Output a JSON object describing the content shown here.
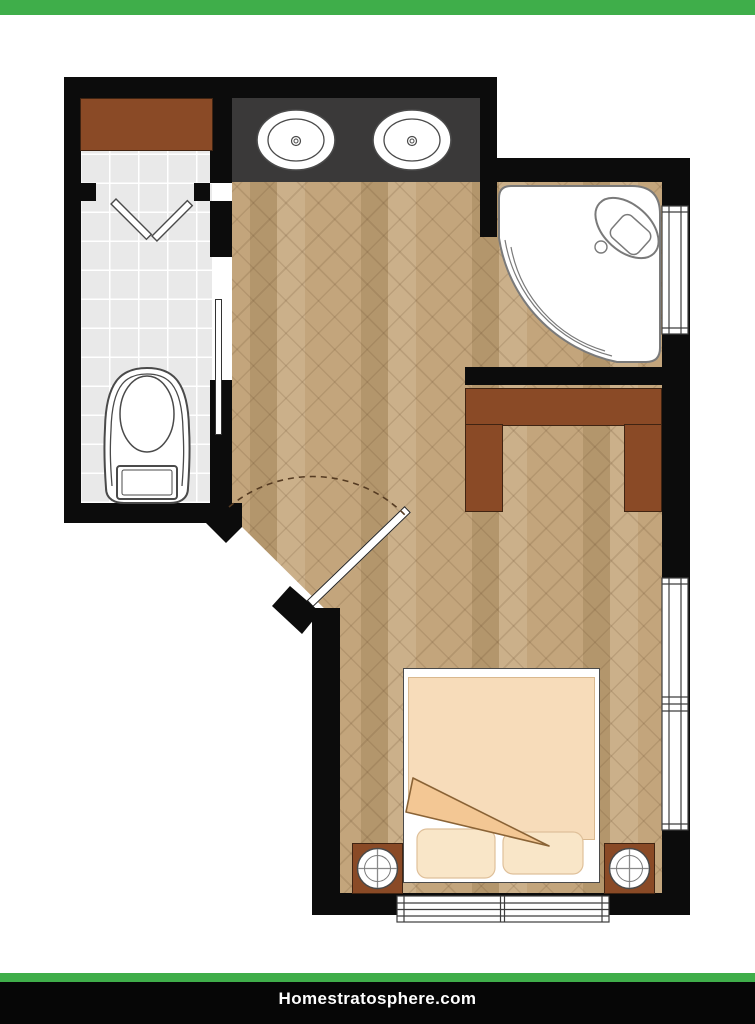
{
  "branding": {
    "site_label": "Homestratosphere.com"
  },
  "colors": {
    "page_white": "#ffffff",
    "accent_green": "#3fae4a",
    "wall_black": "#0c0c0c",
    "footer_black": "#060606",
    "counter_charcoal": "#3a3939",
    "furniture_brown": "#8a4a26",
    "furniture_brown_dark": "#402412",
    "tile_gray": "#e9e9e9",
    "wood_light": "#cbb08a",
    "wood_mid": "#c3a57c",
    "wood_dark": "#b3966c",
    "bed_comforter": "#f7dcba",
    "bed_fold": "#f3c794",
    "bed_pillow": "#f9e6c8"
  },
  "plan": {
    "type": "floor-plan",
    "rooms": [
      "toilet-room",
      "bathroom",
      "bedroom"
    ],
    "fixtures": [
      "closet-shelf",
      "bifold-door",
      "pocket-door",
      "toilet",
      "double-vanity-sinks",
      "corner-shower",
      "shower-head",
      "windows",
      "desk",
      "bed",
      "pillows",
      "blanket-fold",
      "nightstands",
      "lamps",
      "entry-door",
      "door-swing-arc"
    ]
  }
}
